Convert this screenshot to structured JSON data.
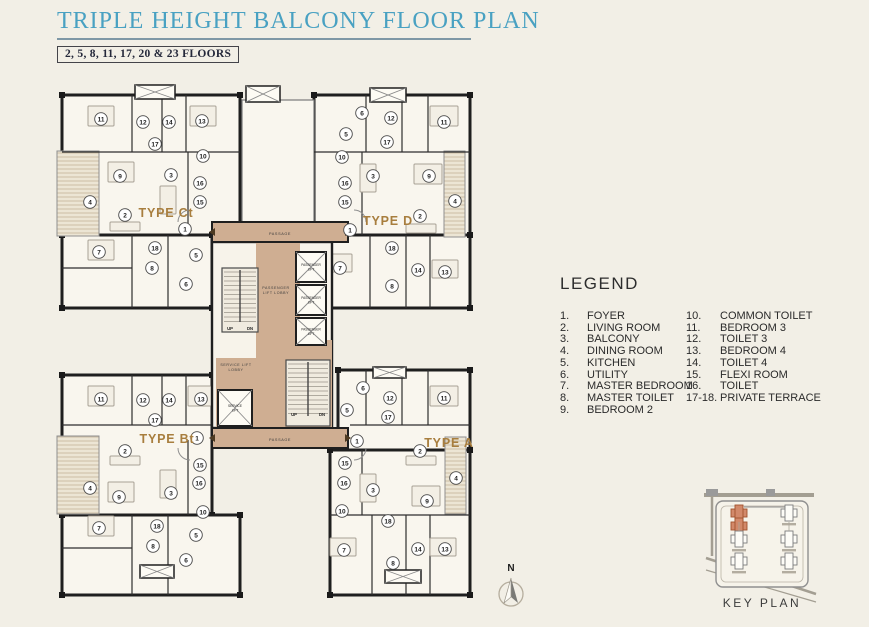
{
  "header": {
    "title": "TRIPLE HEIGHT BALCONY FLOOR PLAN",
    "subtitle": "2, 5, 8, 11, 17, 20 & 23 FLOORS"
  },
  "legend": {
    "title": "LEGEND",
    "col1": [
      [
        "1.",
        "FOYER"
      ],
      [
        "2.",
        "LIVING ROOM"
      ],
      [
        "3.",
        "BALCONY"
      ],
      [
        "4.",
        "DINING ROOM"
      ],
      [
        "5.",
        "KITCHEN"
      ],
      [
        "6.",
        "UTILITY"
      ],
      [
        "7.",
        "MASTER BEDROOM"
      ],
      [
        "8.",
        "MASTER TOILET"
      ],
      [
        "9.",
        "BEDROOM 2"
      ]
    ],
    "col2": [
      [
        "10.",
        "COMMON TOILET"
      ],
      [
        "11.",
        "BEDROOM 3"
      ],
      [
        "12.",
        "TOILET 3"
      ],
      [
        "13.",
        "BEDROOM 4"
      ],
      [
        "14.",
        "TOILET 4"
      ],
      [
        "15.",
        "FLEXI ROOM"
      ],
      [
        "16.",
        "TOILET"
      ],
      [
        "17-18.",
        "PRIVATE TERRACE"
      ]
    ]
  },
  "compass": {
    "label": "N"
  },
  "keyplan": {
    "caption": "KEY PLAN",
    "buildings": [
      [
        739,
        513,
        true
      ],
      [
        739,
        539,
        false
      ],
      [
        739,
        561,
        false
      ],
      [
        789,
        513,
        false
      ],
      [
        789,
        539,
        false
      ],
      [
        789,
        561,
        false
      ]
    ]
  },
  "colors": {
    "accent_teal": "#49a1c2",
    "label_brown": "#a87e3e",
    "passage_tan": "#cfae92",
    "keyplan_highlight": "#d2896a",
    "wall_dark": "#1f1f1f"
  },
  "floorplan": {
    "unit_labels": [
      {
        "text": "TYPE Ct",
        "x": 166,
        "y": 217
      },
      {
        "text": "TYPE D",
        "x": 388,
        "y": 225
      },
      {
        "text": "TYPE Bt",
        "x": 167,
        "y": 443
      },
      {
        "text": "TYPE A",
        "x": 449,
        "y": 447
      }
    ],
    "small_labels": [
      [
        "PASSAGE",
        280,
        235,
        3.8
      ],
      [
        "PASSAGE",
        280,
        441,
        3.8
      ],
      [
        "PASSENGER",
        276,
        289,
        3.6
      ],
      [
        "LIFT LOBBY",
        276,
        294,
        3.6
      ],
      [
        "SERVICE LIFT",
        236,
        366,
        3.6
      ],
      [
        "LOBBY",
        236,
        371,
        3.6
      ]
    ],
    "walls": [
      [
        62,
        95,
        178,
        140
      ],
      [
        62,
        235,
        150,
        73
      ],
      [
        314,
        95,
        156,
        140
      ],
      [
        330,
        235,
        140,
        73
      ],
      [
        62,
        375,
        150,
        140
      ],
      [
        62,
        515,
        178,
        80
      ],
      [
        338,
        370,
        132,
        80
      ],
      [
        330,
        450,
        140,
        145
      ]
    ],
    "top_core": [
      242,
      100,
      72,
      122
    ],
    "terraces": [
      [
        57,
        151,
        42,
        85
      ],
      [
        444,
        151,
        21,
        86
      ],
      [
        57,
        436,
        42,
        78
      ],
      [
        445,
        437,
        21,
        77
      ]
    ],
    "inner_walls": [
      [
        132,
        95,
        132,
        152
      ],
      [
        162,
        95,
        162,
        152
      ],
      [
        186,
        95,
        186,
        152
      ],
      [
        62,
        152,
        240,
        152
      ],
      [
        188,
        152,
        188,
        235
      ],
      [
        132,
        235,
        132,
        308
      ],
      [
        168,
        235,
        168,
        308
      ],
      [
        62,
        268,
        132,
        268
      ],
      [
        366,
        95,
        366,
        152
      ],
      [
        402,
        95,
        402,
        152
      ],
      [
        428,
        95,
        428,
        152
      ],
      [
        314,
        152,
        470,
        152
      ],
      [
        362,
        152,
        362,
        235
      ],
      [
        370,
        235,
        370,
        308
      ],
      [
        406,
        235,
        406,
        308
      ],
      [
        430,
        235,
        430,
        308
      ],
      [
        132,
        375,
        132,
        425
      ],
      [
        162,
        375,
        162,
        425
      ],
      [
        186,
        375,
        186,
        425
      ],
      [
        62,
        425,
        212,
        425
      ],
      [
        188,
        440,
        188,
        515
      ],
      [
        132,
        515,
        132,
        595
      ],
      [
        168,
        515,
        168,
        595
      ],
      [
        62,
        548,
        132,
        548
      ],
      [
        366,
        370,
        366,
        425
      ],
      [
        402,
        370,
        402,
        425
      ],
      [
        428,
        370,
        428,
        425
      ],
      [
        350,
        425,
        470,
        425
      ],
      [
        362,
        450,
        362,
        515
      ],
      [
        330,
        515,
        470,
        515
      ],
      [
        372,
        515,
        372,
        595
      ],
      [
        406,
        515,
        406,
        595
      ],
      [
        430,
        515,
        430,
        595
      ]
    ],
    "furniture": [
      [
        88,
        106,
        26,
        20
      ],
      [
        190,
        106,
        26,
        20
      ],
      [
        108,
        162,
        26,
        20
      ],
      [
        88,
        240,
        26,
        20
      ],
      [
        160,
        186,
        16,
        28
      ],
      [
        110,
        222,
        30,
        9
      ],
      [
        430,
        106,
        28,
        20
      ],
      [
        414,
        164,
        28,
        20
      ],
      [
        406,
        224,
        30,
        9
      ],
      [
        360,
        164,
        16,
        28
      ],
      [
        326,
        254,
        26,
        18
      ],
      [
        432,
        260,
        26,
        18
      ],
      [
        88,
        386,
        26,
        20
      ],
      [
        188,
        386,
        26,
        20
      ],
      [
        108,
        482,
        26,
        20
      ],
      [
        160,
        470,
        16,
        28
      ],
      [
        110,
        456,
        30,
        9
      ],
      [
        88,
        516,
        26,
        20
      ],
      [
        430,
        386,
        28,
        20
      ],
      [
        412,
        486,
        28,
        20
      ],
      [
        406,
        456,
        30,
        9
      ],
      [
        360,
        474,
        16,
        28
      ],
      [
        330,
        538,
        26,
        18
      ],
      [
        430,
        538,
        26,
        18
      ]
    ],
    "core_fills": [
      [
        212,
        222,
        136,
        20
      ],
      [
        256,
        242,
        44,
        186
      ],
      [
        216,
        358,
        40,
        70
      ],
      [
        298,
        340,
        34,
        88
      ],
      [
        212,
        428,
        136,
        20
      ]
    ],
    "passage_bars": [
      [
        212,
        222,
        136,
        20
      ],
      [
        212,
        428,
        136,
        20
      ]
    ],
    "arrows": [
      [
        215,
        232,
        "l"
      ],
      [
        345,
        232,
        "r"
      ],
      [
        215,
        438,
        "l"
      ],
      [
        345,
        438,
        "r"
      ]
    ],
    "lifts": [
      {
        "x": 296,
        "y": 252,
        "w": 30,
        "h": 30,
        "label": "PASSENGER|LIFT"
      },
      {
        "x": 296,
        "y": 285,
        "w": 30,
        "h": 30,
        "label": "PASSENGER|LIFT"
      },
      {
        "x": 296,
        "y": 318,
        "w": 30,
        "h": 27,
        "label": "PASSENGER|LIFT"
      },
      {
        "x": 218,
        "y": 390,
        "w": 34,
        "h": 36,
        "label": "SERVICE|LIFT"
      }
    ],
    "shafts": [
      [
        246,
        86,
        34,
        16
      ],
      [
        135,
        85,
        40,
        14
      ],
      [
        370,
        88,
        36,
        14
      ],
      [
        140,
        565,
        34,
        13
      ],
      [
        385,
        570,
        36,
        13
      ],
      [
        373,
        367,
        33,
        11
      ]
    ],
    "stairs": [
      {
        "x": 222,
        "y": 268,
        "w": 36,
        "h": 64,
        "ly": 330,
        "up": "UP",
        "dn": "DN"
      },
      {
        "x": 286,
        "y": 360,
        "w": 44,
        "h": 66,
        "ly": 416,
        "up": "UP",
        "dn": "DN"
      }
    ],
    "doors": [
      "M178,222 a12,12 0 0 1 12,-12",
      "M366,222 a12,12 0 0 0 -12,-12",
      "M178,448 a12,12 0 0 0 12,12",
      "M366,448 a12,12 0 0 1 -12,12"
    ],
    "rooms": {
      "type_ct": [
        [
          "11",
          101,
          119
        ],
        [
          "12",
          143,
          122
        ],
        [
          "14",
          169,
          122
        ],
        [
          "13",
          202,
          121
        ],
        [
          "17",
          155,
          144
        ],
        [
          "10",
          203,
          156
        ],
        [
          "9",
          120,
          176
        ],
        [
          "3",
          171,
          175
        ],
        [
          "16",
          200,
          183
        ],
        [
          "4",
          90,
          202
        ],
        [
          "15",
          200,
          202
        ],
        [
          "2",
          125,
          215
        ],
        [
          "1",
          185,
          229
        ],
        [
          "18",
          155,
          248
        ],
        [
          "7",
          99,
          252
        ],
        [
          "5",
          196,
          255
        ],
        [
          "8",
          152,
          268
        ],
        [
          "6",
          186,
          284
        ]
      ],
      "type_d": [
        [
          "6",
          362,
          113
        ],
        [
          "12",
          391,
          118
        ],
        [
          "11",
          444,
          122
        ],
        [
          "5",
          346,
          134
        ],
        [
          "17",
          387,
          142
        ],
        [
          "10",
          342,
          157
        ],
        [
          "3",
          373,
          176
        ],
        [
          "9",
          429,
          176
        ],
        [
          "16",
          345,
          183
        ],
        [
          "4",
          455,
          201
        ],
        [
          "15",
          345,
          202
        ],
        [
          "2",
          420,
          216
        ],
        [
          "1",
          350,
          230
        ],
        [
          "18",
          392,
          248
        ],
        [
          "7",
          340,
          268
        ],
        [
          "14",
          418,
          270
        ],
        [
          "13",
          445,
          272
        ],
        [
          "8",
          392,
          286
        ]
      ],
      "type_bt": [
        [
          "11",
          101,
          399
        ],
        [
          "12",
          143,
          400
        ],
        [
          "14",
          169,
          400
        ],
        [
          "13",
          201,
          399
        ],
        [
          "17",
          155,
          420
        ],
        [
          "1",
          197,
          438
        ],
        [
          "2",
          125,
          451
        ],
        [
          "15",
          200,
          465
        ],
        [
          "16",
          199,
          483
        ],
        [
          "4",
          90,
          488
        ],
        [
          "3",
          171,
          493
        ],
        [
          "9",
          119,
          497
        ],
        [
          "10",
          203,
          512
        ],
        [
          "18",
          157,
          526
        ],
        [
          "7",
          99,
          528
        ],
        [
          "5",
          196,
          535
        ],
        [
          "8",
          153,
          546
        ],
        [
          "6",
          186,
          560
        ]
      ],
      "type_a": [
        [
          "6",
          363,
          388
        ],
        [
          "12",
          390,
          398
        ],
        [
          "11",
          444,
          398
        ],
        [
          "5",
          347,
          410
        ],
        [
          "17",
          388,
          417
        ],
        [
          "1",
          357,
          441
        ],
        [
          "2",
          420,
          451
        ],
        [
          "15",
          345,
          463
        ],
        [
          "4",
          456,
          478
        ],
        [
          "16",
          344,
          483
        ],
        [
          "3",
          373,
          490
        ],
        [
          "9",
          427,
          501
        ],
        [
          "10",
          342,
          511
        ],
        [
          "18",
          388,
          521
        ],
        [
          "7",
          344,
          550
        ],
        [
          "14",
          418,
          549
        ],
        [
          "13",
          445,
          549
        ],
        [
          "8",
          393,
          563
        ]
      ]
    }
  }
}
